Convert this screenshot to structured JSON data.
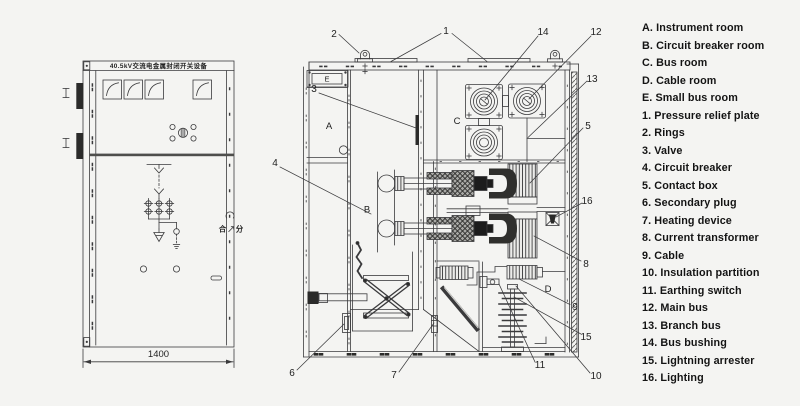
{
  "colors": {
    "background": "#f4f4f2",
    "ink": "#3a3a3c",
    "dark_fill": "#2b2b2a"
  },
  "front_view": {
    "title": "40.5kV交流电金属封闭开关设备",
    "width_dimension": "1400",
    "handle_close": "合",
    "handle_open": "分"
  },
  "section_view": {
    "room_labels": {
      "A": "A",
      "B": "B",
      "C": "C",
      "D": "D",
      "E": "E"
    },
    "callouts": {
      "c1": "1",
      "c2": "2",
      "c3": "3",
      "c4": "4",
      "c5": "5",
      "c6": "6",
      "c7": "7",
      "c8": "8",
      "c9": "9",
      "c10": "10",
      "c11": "11",
      "c12": "12",
      "c13": "13",
      "c14": "14",
      "c15": "15",
      "c16": "16"
    }
  },
  "legend": {
    "items": [
      "A. Instrument room",
      "B. Circuit breaker room",
      "C. Bus room",
      "D. Cable room",
      "E. Small bus room",
      "1. Pressure relief plate",
      "2. Rings",
      "3. Valve",
      "4. Circuit breaker",
      "5. Contact box",
      "6. Secondary plug",
      "7. Heating device",
      "8. Current transformer",
      "9. Cable",
      "10. Insulation partition",
      "11. Earthing switch",
      "12. Main bus",
      "13. Branch bus",
      "14. Bus bushing",
      "15. Lightning arrester",
      "16. Lighting"
    ]
  }
}
